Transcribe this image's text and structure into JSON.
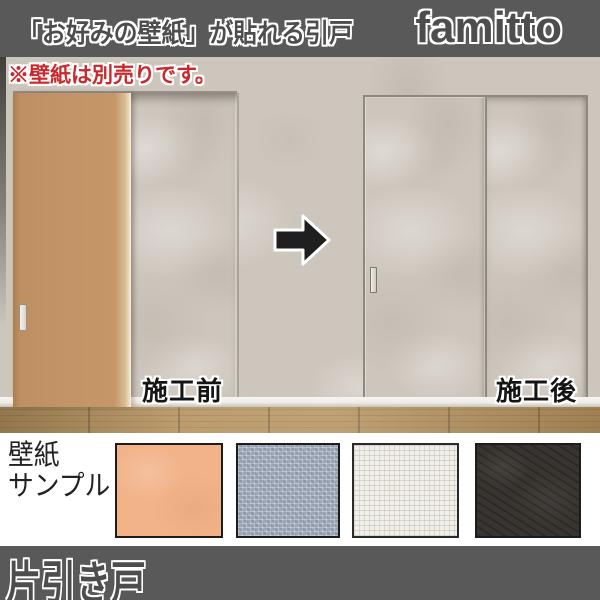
{
  "header": {
    "title": "「お好みの壁紙」が貼れる引戸",
    "brand": "famitto"
  },
  "scene": {
    "notice": "※壁紙は別売りです。",
    "before_label": "施工前",
    "after_label": "施工後",
    "arrow_icon": "right-arrow"
  },
  "samples": {
    "title_line1": "壁紙",
    "title_line2": "サンプル",
    "swatches": [
      {
        "name": "peach-plain-wallpaper",
        "color": "#f2b389"
      },
      {
        "name": "blue-gray-weave-wallpaper",
        "color": "#9ca7b7"
      },
      {
        "name": "white-grid-wallpaper",
        "color": "#f1efe9"
      },
      {
        "name": "dark-brown-leather-wallpaper",
        "color": "#393430"
      }
    ]
  },
  "footer": {
    "label": "片引き戸"
  },
  "colors": {
    "bar_background": "#595959",
    "wall": "#cdc6bd",
    "door_before": "#c09265",
    "floor_wood": "#b5925f",
    "notice_red": "#c9282d",
    "arrow_black": "#1f1f1f"
  }
}
